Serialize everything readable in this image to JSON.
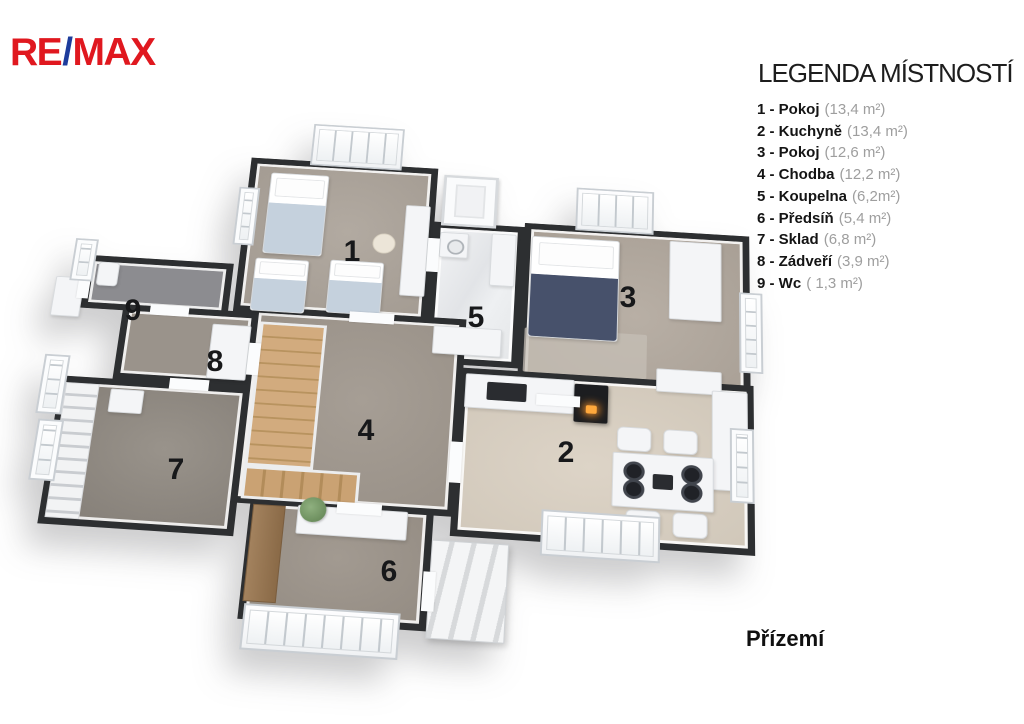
{
  "brand": {
    "re": "RE",
    "slash": "/",
    "max": "MAX",
    "colors": {
      "red": "#e0181f",
      "blue": "#1d3c9c"
    }
  },
  "legend": {
    "title": "LEGENDA MÍSTNOSTÍ",
    "items": [
      {
        "label": "1 - Pokoj",
        "area": "(13,4 m²)"
      },
      {
        "label": "2 - Kuchyně",
        "area": "(13,4 m²)"
      },
      {
        "label": "3 - Pokoj",
        "area": "(12,6 m²)"
      },
      {
        "label": "4 - Chodba",
        "area": "(12,2 m²)"
      },
      {
        "label": "5 - Koupelna",
        "area": "(6,2m²)"
      },
      {
        "label": "6 - Předsíň",
        "area": "(5,4 m²)"
      },
      {
        "label": "7 - Sklad",
        "area": "(6,8 m²)"
      },
      {
        "label": "8 - Zádveří",
        "area": "(3,9 m²)"
      },
      {
        "label": "9 - Wc",
        "area": "( 1,3 m²)"
      }
    ]
  },
  "floor_label": "Přízemí",
  "plan": {
    "room_numbers": [
      "1",
      "2",
      "3",
      "4",
      "5",
      "6",
      "7",
      "8",
      "9"
    ],
    "wall_color": "#2d2f31"
  }
}
